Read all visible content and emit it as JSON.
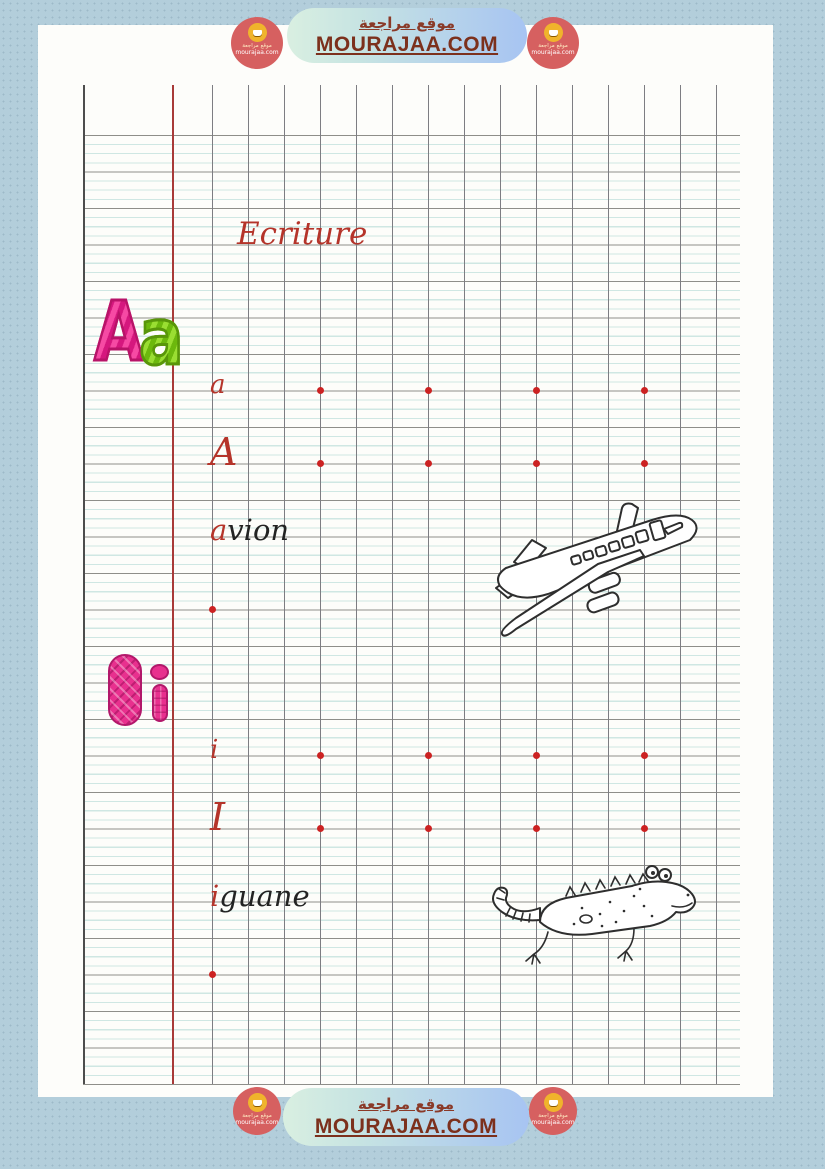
{
  "brand": {
    "site_name_ar": "موقع مراجعة",
    "site_url": "MOURAJAA.COM",
    "badge": {
      "name_ar": "موقع مراجعة",
      "domain": "mourajaa.com"
    }
  },
  "worksheet": {
    "title": "Ecriture",
    "alphabet_display": {
      "a_upper": "A",
      "a_lower": "a",
      "i_upper": "I",
      "i_lower": "i"
    },
    "practice": {
      "row_a": "a",
      "row_A": "A",
      "avion": {
        "first": "a",
        "rest": "vion"
      },
      "row_i": "i",
      "row_I": "I",
      "iguane": {
        "first": "i",
        "rest": "guane"
      }
    },
    "figures": {
      "airplane": "avion",
      "iguana": "iguane"
    },
    "guide_dots": {
      "letter_row_columns": 4,
      "word_row_columns": 1
    }
  },
  "colors": {
    "background": "#b3cedb",
    "paper": "#fdfdfa",
    "margin_red": "#a83a38",
    "rule_major": "#8e8e89",
    "rule_light": "#cfe7e3",
    "accent_red": "#b5342a",
    "dot_red": "#cc2222",
    "bubble_pink": "#e8308e",
    "bubble_green": "#86ca1f",
    "brand_text": "#7c301c",
    "badge_red": "#d66060",
    "badge_yellow": "#f0b42c"
  }
}
